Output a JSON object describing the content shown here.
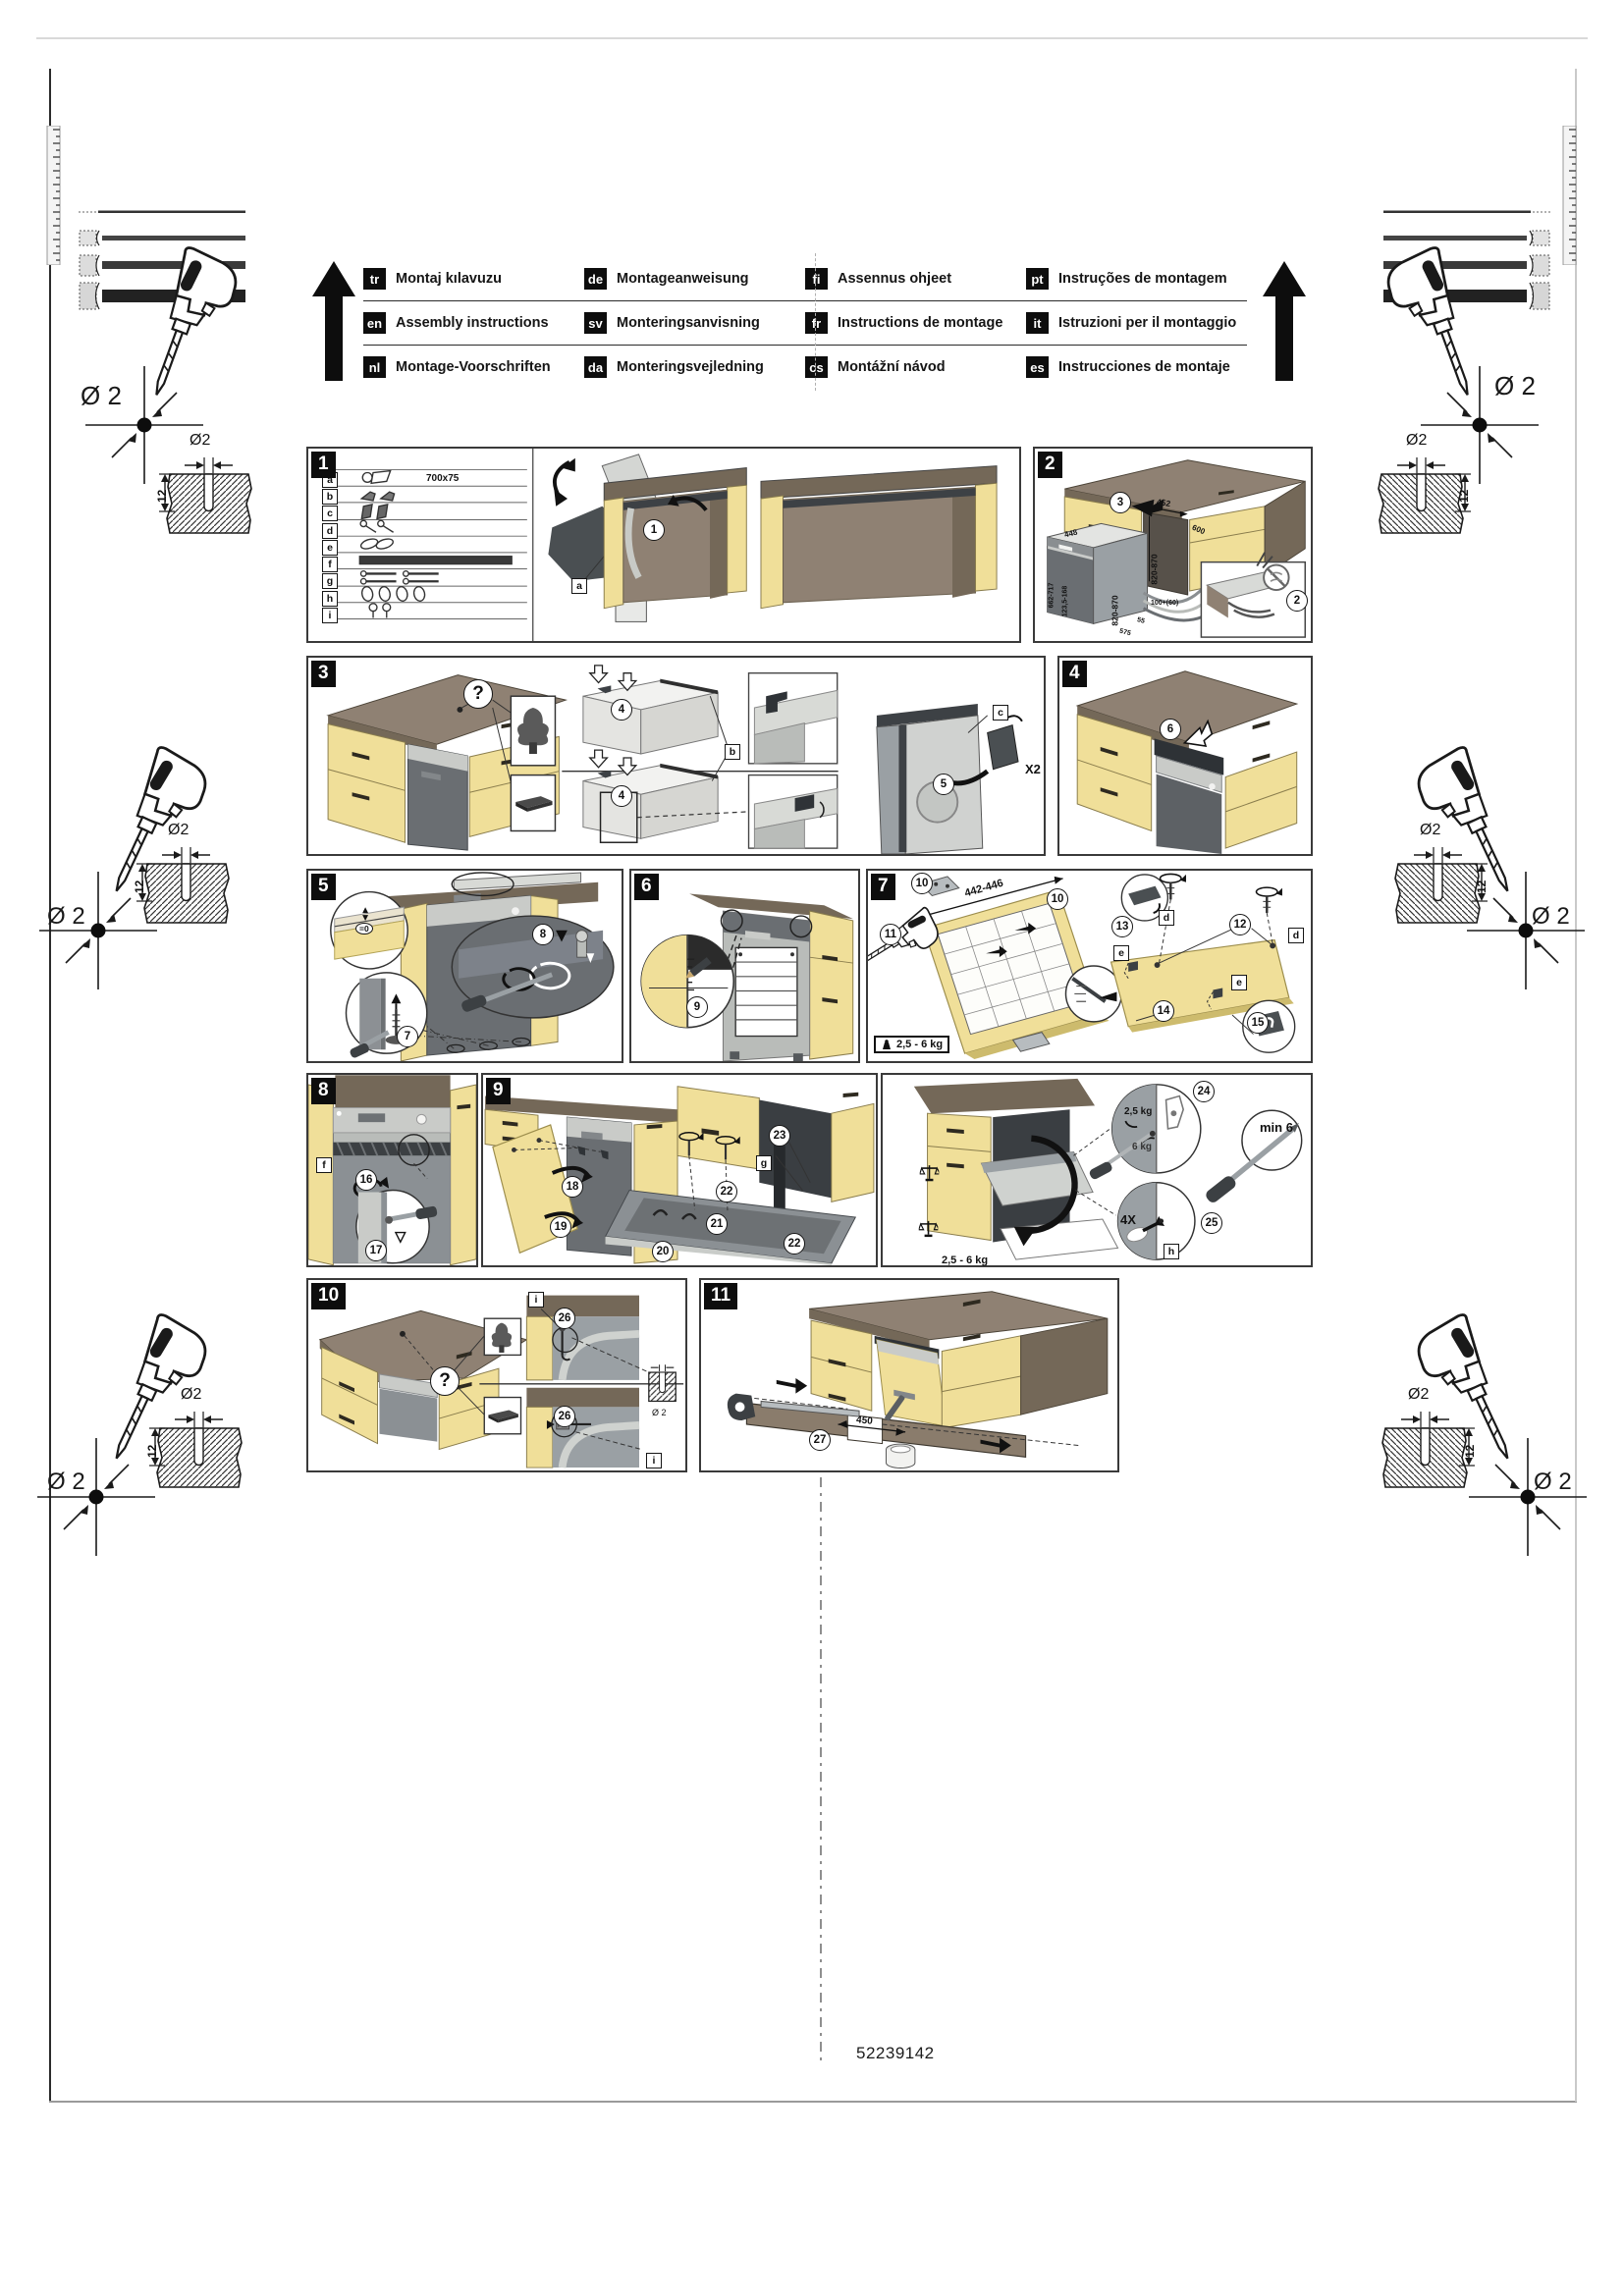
{
  "header": {
    "rows": [
      [
        {
          "code": "tr",
          "label": "Montaj kılavuzu"
        },
        {
          "code": "de",
          "label": "Montageanweisung"
        },
        {
          "code": "fi",
          "label": "Assennus ohjeet"
        },
        {
          "code": "pt",
          "label": "Instruções de montagem"
        }
      ],
      [
        {
          "code": "en",
          "label": "Assembly instructions"
        },
        {
          "code": "sv",
          "label": "Monteringsanvisning"
        },
        {
          "code": "fr",
          "label": "Instructions de montage"
        },
        {
          "code": "it",
          "label": "Istruzioni per il montaggio"
        }
      ],
      [
        {
          "code": "nl",
          "label": "Montage-Voorschriften"
        },
        {
          "code": "da",
          "label": "Monteringsvejledning"
        },
        {
          "code": "cs",
          "label": "Montážní návod"
        },
        {
          "code": "es",
          "label": "Instrucciones de montaje"
        }
      ]
    ]
  },
  "corners": {
    "dia": "Ø 2",
    "hole_dia": "Ø2",
    "depth": "12"
  },
  "footer": {
    "doc_number": "52239142"
  },
  "panels": {
    "p1": {
      "num": "1",
      "c1": "1",
      "label_a": "a",
      "parts": [
        {
          "k": "a",
          "note": "700x75"
        },
        {
          "k": "b"
        },
        {
          "k": "c"
        },
        {
          "k": "d"
        },
        {
          "k": "e"
        },
        {
          "k": "f"
        },
        {
          "k": "g"
        },
        {
          "k": "h"
        },
        {
          "k": "i"
        }
      ]
    },
    "p2": {
      "num": "2",
      "c3": "3",
      "c2": "2",
      "dim_niche_w": "452",
      "dim_niche_h": "820-870",
      "dim_depth": "600",
      "dim_dw_w": "448",
      "dim_dw_h": "820-870",
      "dim_left_a": "662-717",
      "dim_left_b": "123,5-168",
      "dim_hose": "100+(60)",
      "dim_a": "55",
      "dim_b": "575"
    },
    "p3": {
      "num": "3",
      "q": "?",
      "c4": "4",
      "c5": "5",
      "label_b": "b",
      "label_c": "c",
      "x2": "X2"
    },
    "p4": {
      "num": "4",
      "c6": "6"
    },
    "p5": {
      "num": "5",
      "c7": "7",
      "c8": "8",
      "gap": "=0"
    },
    "p6": {
      "num": "6",
      "c9": "9"
    },
    "p7": {
      "num": "7",
      "c10": "10",
      "c11": "11",
      "c12": "12",
      "c13": "13",
      "c14": "14",
      "c15": "15",
      "label_d": "d",
      "label_e": "e",
      "dim": "442-446",
      "weight": "2,5 - 6 kg"
    },
    "p8": {
      "num": "8",
      "c16": "16",
      "c17": "17",
      "label_f": "f"
    },
    "p9": {
      "num": "9",
      "c18": "18",
      "c19": "19",
      "c20": "20",
      "c21": "21",
      "c22": "22",
      "c23": "23",
      "label_g": "g"
    },
    "p9b": {
      "weight": "2,5 - 6 kg",
      "c24": "24",
      "c25": "25",
      "kg_min": "2,5 kg",
      "kg_max": "6 kg",
      "min6": "min 6",
      "x4": "4X",
      "label_h": "h"
    },
    "p10": {
      "num": "10",
      "q": "?",
      "c26": "26",
      "label_i": "i",
      "dia": "Ø 2"
    },
    "p11": {
      "num": "11",
      "c27": "27",
      "dim": "450"
    }
  }
}
